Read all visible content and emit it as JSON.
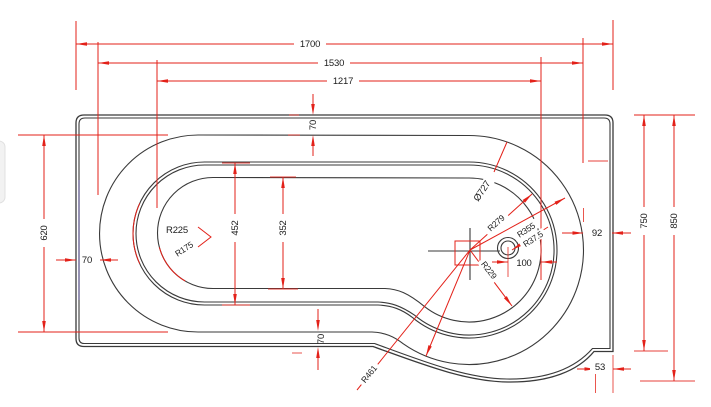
{
  "drawing": {
    "description": "P-shaped bath plan technical drawing",
    "top_dims": {
      "overall": "1700",
      "second": "1530",
      "third": "1217"
    },
    "left_dims": {
      "height": "620",
      "wall": "70"
    },
    "inner_dims": {
      "outer_width": "452",
      "inner_width": "352",
      "rim_top": "70",
      "rim_bottom": "70"
    },
    "right_dims": {
      "gap": "92",
      "width_inner": "750",
      "width_overall": "850",
      "corner": "53",
      "drain_offset": "100"
    },
    "radius_labels": {
      "r225": "R225",
      "r175": "R175",
      "dia727": "Ø727",
      "r279": "R279",
      "r355": "R355",
      "r37_5": "R37.5",
      "r229": "R229",
      "r461": "R461"
    },
    "colors": {
      "dimension_red": "#e32119",
      "outline_black": "#3a3a3a",
      "label_black": "#1c1c1c",
      "accent_purple": "#43398f"
    }
  }
}
